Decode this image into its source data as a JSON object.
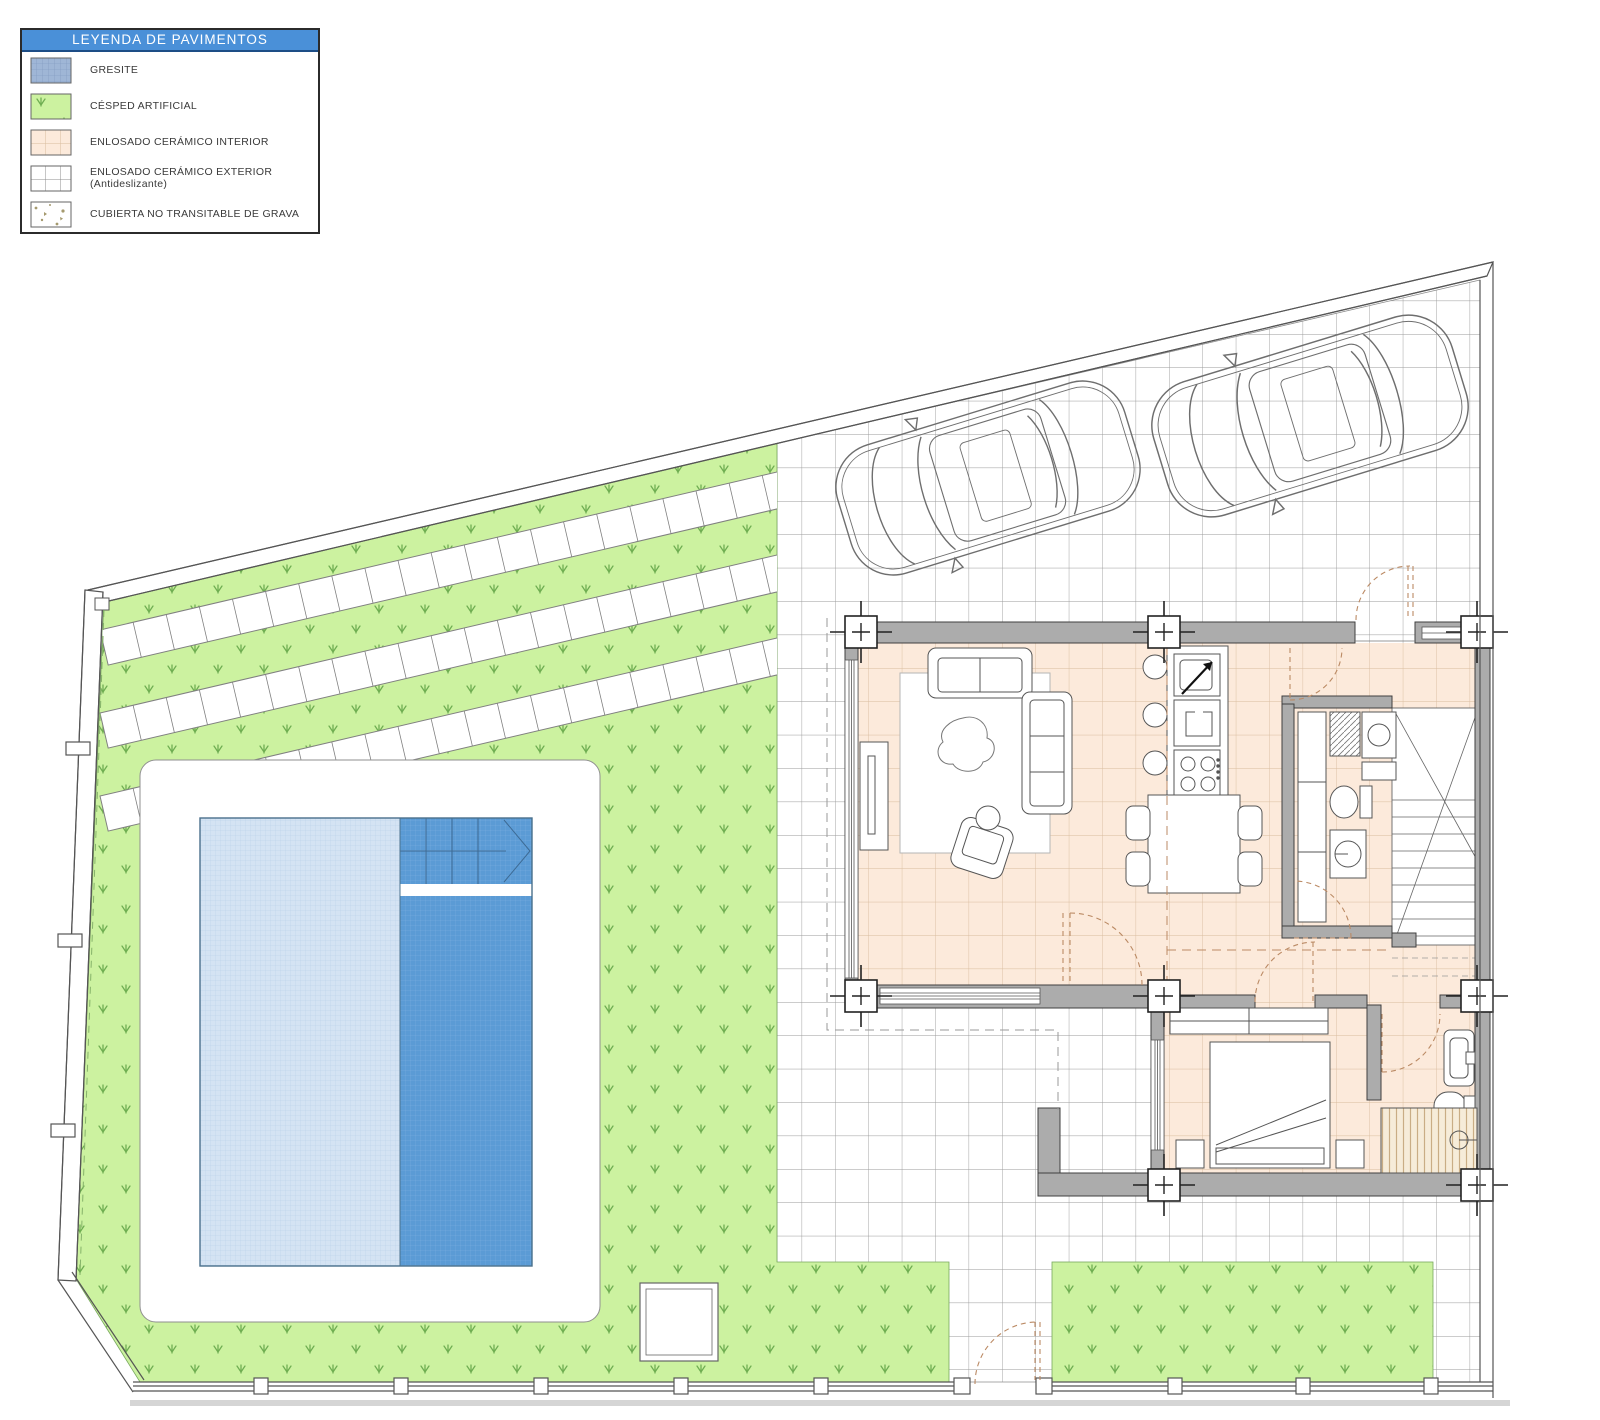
{
  "legend": {
    "title": "LEYENDA DE PAVIMENTOS",
    "items": [
      {
        "label": "GRESITE",
        "swatch": "gresite-swatch"
      },
      {
        "label": "CÉSPED ARTIFICIAL",
        "swatch": "artificial-grass-swatch"
      },
      {
        "label": "ENLOSADO CERÁMICO INTERIOR",
        "swatch": "interior-ceramic-swatch"
      },
      {
        "label": "ENLOSADO CERÁMICO EXTERIOR (Antideslizante)",
        "swatch": "exterior-ceramic-swatch"
      },
      {
        "label": "CUBIERTA NO TRANSITABLE DE GRAVA",
        "swatch": "gravel-roof-swatch"
      }
    ]
  },
  "colors": {
    "legend_header": "#4a90d8",
    "grass": "#ccf2a0",
    "grass_mark": "#6fae52",
    "pool_light": "#d4e3f3",
    "pool_light_line": "#b6cde8",
    "pool_dark": "#5b9bd5",
    "pool_dark_line": "#7fb2e2",
    "gresite_swatch": "#9fb6d6",
    "gresite_line": "#7e97bd",
    "interior": "#fceadb",
    "interior_line": "#d9bc9e",
    "tile_line": "#9a9a9a",
    "wall": "#acacac",
    "wall_edge": "#3f3f3f",
    "line": "#555555",
    "door_dash": "#bb8a64",
    "gravel_dot": "#a59a6e"
  }
}
